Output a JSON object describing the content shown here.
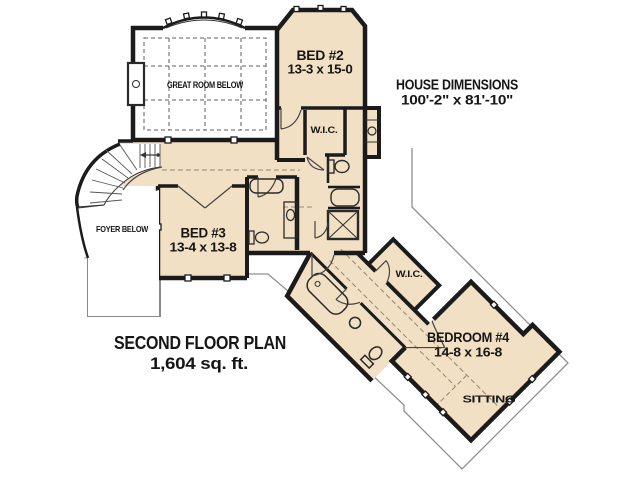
{
  "title": "Second Floor Plan drawing",
  "colors": {
    "floor_fill": "#f2e0c4",
    "wall": "#1b1b1b",
    "background": "#ffffff",
    "roof_outline": "#8f8f8f"
  },
  "annotations": {
    "house_dimensions_title": "HOUSE DIMENSIONS",
    "house_dimensions_value": "100'-2\" x 81'-10\"",
    "plan_title": "SECOND FLOOR PLAN",
    "plan_area": "1,604 sq. ft."
  },
  "rooms": {
    "great_room": {
      "label": "GREAT ROOM BELOW"
    },
    "bed2": {
      "label": "BED #2",
      "dimensions": "13-3 x 15-0"
    },
    "wic_bed2": {
      "label": "W.I.C."
    },
    "foyer": {
      "label": "FOYER BELOW"
    },
    "bed3": {
      "label": "BED #3",
      "dimensions": "13-4 x 13-8"
    },
    "wic_bed4": {
      "label": "W.I.C."
    },
    "bedroom4": {
      "label": "BEDROOM #4",
      "dimensions": "14-8 x 16-8"
    },
    "sitting": {
      "label": "SITTING"
    }
  }
}
